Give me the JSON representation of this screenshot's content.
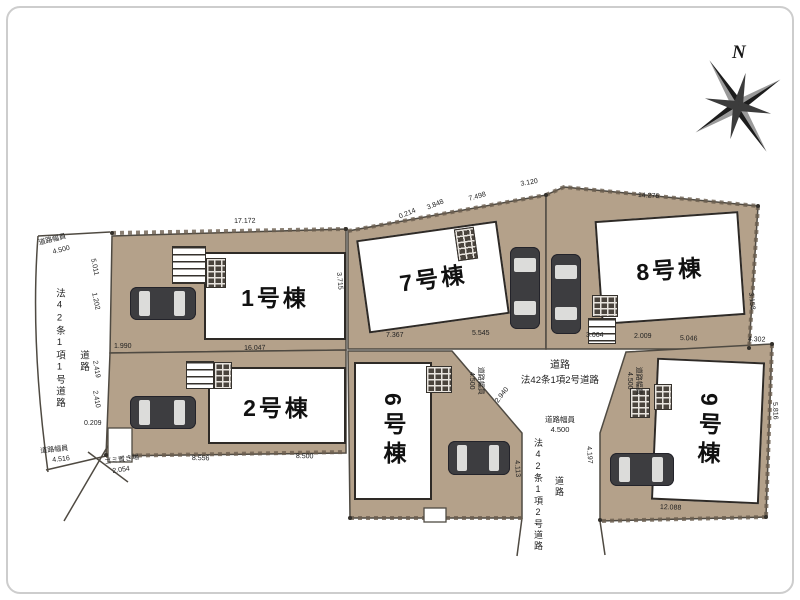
{
  "colors": {
    "lot_tan": "#b4a18a",
    "outline": "#4f4a42",
    "car_body": "#3d3d40"
  },
  "compass": {
    "label": "N"
  },
  "buildings": [
    {
      "label": "1号棟"
    },
    {
      "label": "2号棟"
    },
    {
      "label": "6号棟"
    },
    {
      "label": "7号棟"
    },
    {
      "label": "8号棟"
    },
    {
      "label": "9号棟"
    }
  ],
  "roads": {
    "left_vertical": {
      "type_label": "法42条1項1号道路",
      "name_label": "道路"
    },
    "center": {
      "name_label": "道路",
      "type_label": "法42条1項2号道路",
      "width_label": "道路幅員",
      "width_value": "4.500"
    },
    "bottom_vertical": {
      "type_label": "法42条1項2号道路",
      "name_label": "道路"
    }
  },
  "annotations": [
    {
      "t": "道路幅員",
      "x": 38,
      "y": 240,
      "r": -14
    },
    {
      "t": "4.500",
      "x": 52,
      "y": 249,
      "r": -14
    },
    {
      "t": "5.011",
      "x": 96,
      "y": 258,
      "r": 78
    },
    {
      "t": "1.202",
      "x": 97,
      "y": 292,
      "r": 78
    },
    {
      "t": "2.419",
      "x": 98,
      "y": 360,
      "r": 80
    },
    {
      "t": "2.410",
      "x": 98,
      "y": 390,
      "r": 80
    },
    {
      "t": "0.209",
      "x": 84,
      "y": 420,
      "r": 0
    },
    {
      "t": "道路幅員",
      "x": 40,
      "y": 448,
      "r": -6
    },
    {
      "t": "4.516",
      "x": 52,
      "y": 457,
      "r": -6
    },
    {
      "t": "17.172",
      "x": 234,
      "y": 218,
      "r": -1
    },
    {
      "t": "0.214",
      "x": 398,
      "y": 214,
      "r": -22
    },
    {
      "t": "3.848",
      "x": 426,
      "y": 205,
      "r": -22
    },
    {
      "t": "7.498",
      "x": 468,
      "y": 196,
      "r": -16
    },
    {
      "t": "3.120",
      "x": 520,
      "y": 181,
      "r": -10
    },
    {
      "t": "14.276",
      "x": 638,
      "y": 192,
      "r": 3
    },
    {
      "t": "1.990",
      "x": 114,
      "y": 343,
      "r": 0
    },
    {
      "t": "16.047",
      "x": 244,
      "y": 345,
      "r": -1
    },
    {
      "t": "3.715",
      "x": 342,
      "y": 272,
      "r": 85
    },
    {
      "t": "8.556",
      "x": 192,
      "y": 455,
      "r": 1
    },
    {
      "t": "8.500",
      "x": 296,
      "y": 453,
      "r": 1
    },
    {
      "t": "ゴミ置き場",
      "x": 104,
      "y": 459,
      "r": -8
    },
    {
      "t": "2.054",
      "x": 112,
      "y": 468,
      "r": -8
    },
    {
      "t": "7.367",
      "x": 386,
      "y": 332,
      "r": 0
    },
    {
      "t": "5.545",
      "x": 472,
      "y": 330,
      "r": 0
    },
    {
      "t": "3.064",
      "x": 586,
      "y": 332,
      "r": 0
    },
    {
      "t": "2.009",
      "x": 634,
      "y": 333,
      "r": 0
    },
    {
      "t": "5.046",
      "x": 680,
      "y": 335,
      "r": 2
    },
    {
      "t": "4.302",
      "x": 748,
      "y": 336,
      "r": 2
    },
    {
      "t": "3.158",
      "x": 754,
      "y": 292,
      "r": 84
    },
    {
      "t": "2.940",
      "x": 494,
      "y": 400,
      "r": -52
    },
    {
      "t": "4.113",
      "x": 520,
      "y": 460,
      "r": 86
    },
    {
      "t": "4.197",
      "x": 592,
      "y": 446,
      "r": 86
    },
    {
      "t": "5.816",
      "x": 778,
      "y": 402,
      "r": 88
    },
    {
      "t": "12.088",
      "x": 660,
      "y": 504,
      "r": 2
    }
  ]
}
